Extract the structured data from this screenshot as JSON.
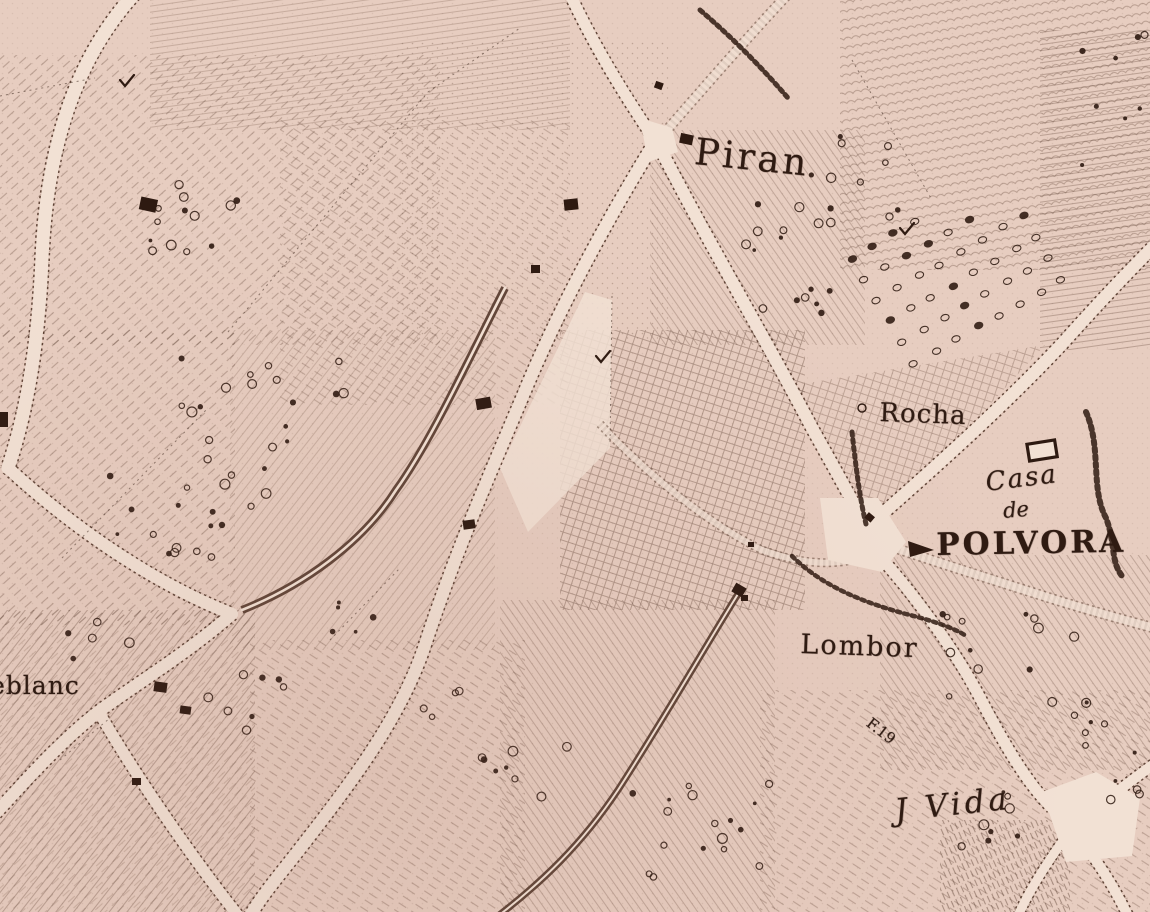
{
  "map": {
    "type": "historical-engraved-map",
    "labels": {
      "piran": {
        "text": "Piran"
      },
      "rocha": {
        "text": "Rocha"
      },
      "casa_line1": {
        "text": "Casa"
      },
      "casa_line2": {
        "text": "de"
      },
      "polvora": {
        "text": "POLVORA"
      },
      "lombor": {
        "text": "Lombor"
      },
      "j_vida": {
        "text": "J Vida"
      },
      "eblanc": {
        "text": "eblanc"
      },
      "field_note": {
        "text": "F.19"
      }
    },
    "colors": {
      "paper": "#e6ccbf",
      "road": "#f1e0d3",
      "ink": "#2f1b12",
      "engraving_stroke": "#53392b"
    }
  }
}
